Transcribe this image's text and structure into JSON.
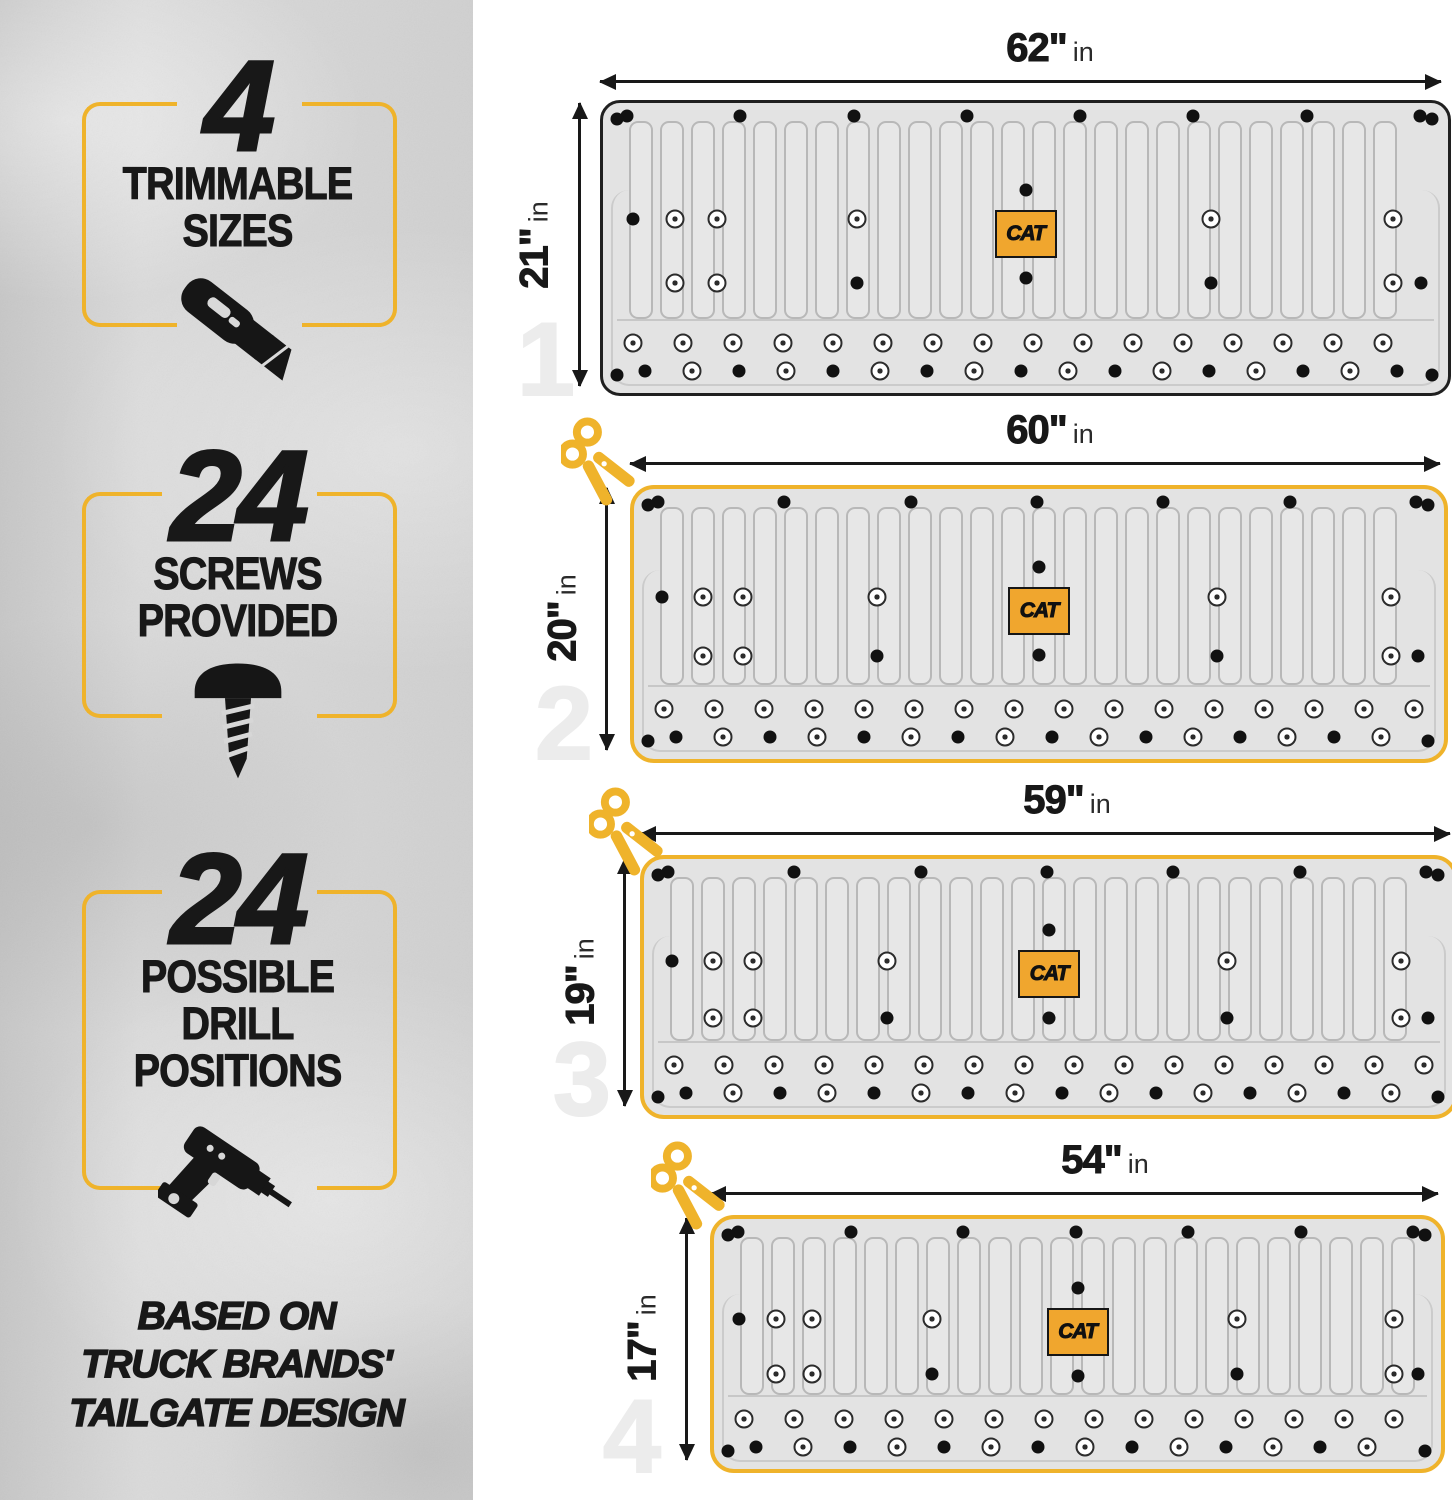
{
  "sidebar": {
    "features": [
      {
        "number": "4",
        "label_lines": [
          "TRIMMABLE",
          "SIZES"
        ],
        "icon": "utility-knife"
      },
      {
        "number": "24",
        "label_lines": [
          "SCREWS",
          "PROVIDED"
        ],
        "icon": "screw"
      },
      {
        "number": "24",
        "label_lines": [
          "POSSIBLE",
          "DRILL",
          "POSITIONS"
        ],
        "icon": "drill"
      }
    ],
    "footnote_lines": [
      "BASED ON",
      "TRUCK BRANDS'",
      "TAILGATE DESIGN"
    ]
  },
  "diagram": {
    "brand": "CAT",
    "unit": "in",
    "mats": [
      {
        "index": "1",
        "width_label": "62\"",
        "height_label": "21\"",
        "width_in": 62,
        "height_in": 21,
        "trim_scissors": false,
        "outline": "black"
      },
      {
        "index": "2",
        "width_label": "60\"",
        "height_label": "20\"",
        "width_in": 60,
        "height_in": 20,
        "trim_scissors": true,
        "outline": "gold"
      },
      {
        "index": "3",
        "width_label": "59\"",
        "height_label": "19\"",
        "width_in": 59,
        "height_in": 19,
        "trim_scissors": true,
        "outline": "gold"
      },
      {
        "index": "4",
        "width_label": "54\"",
        "height_label": "17\"",
        "width_in": 54,
        "height_in": 17,
        "trim_scissors": true,
        "outline": "gold"
      }
    ]
  },
  "colors": {
    "accent_gold": "#EFB32B",
    "logo_orange": "#F0A62E",
    "ink": "#181818",
    "watermark_gray": "#ECECEC",
    "mat_fill": "#E3E3E3",
    "mat_line": "#B8B8B8",
    "sidebar_gray": "#D6D6D6"
  }
}
